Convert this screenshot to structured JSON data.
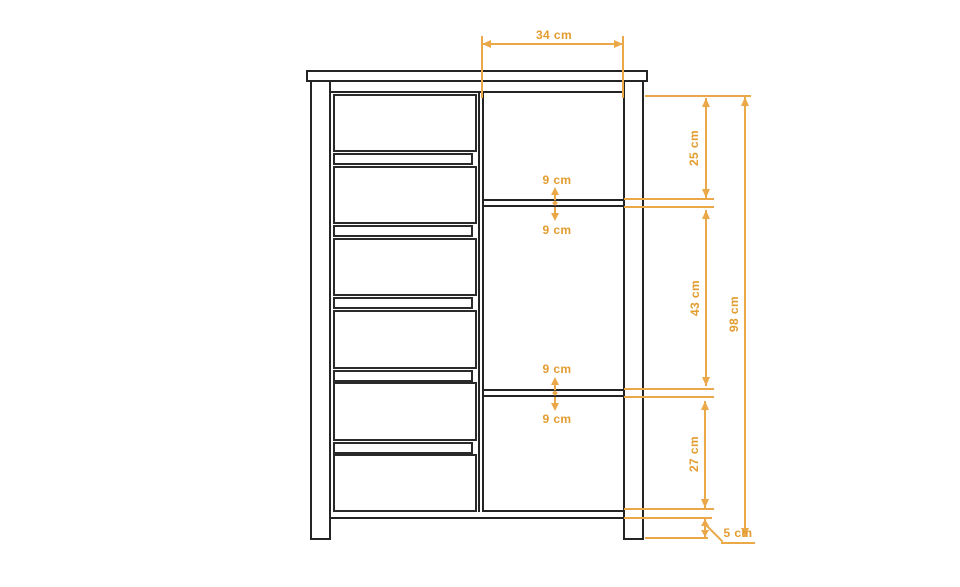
{
  "diagram": {
    "type": "furniture-technical-drawing",
    "subject": "chest with drawers and adjustable shelves, front elevation",
    "unit": "cm",
    "colors": {
      "dimension_line": "#EAA848",
      "dimension_text": "#E39C2F",
      "outline": "#242424",
      "background": "#FFFFFF"
    },
    "dimensions": {
      "opening_width": "34 cm",
      "top_section_height": "25 cm",
      "middle_section_height": "43 cm",
      "bottom_section_height": "27 cm",
      "total_height": "98 cm",
      "plinth_height": "5 cm",
      "shelf1_above": "9 cm",
      "shelf1_below": "9 cm",
      "shelf2_above": "9 cm",
      "shelf2_below": "9 cm"
    }
  }
}
